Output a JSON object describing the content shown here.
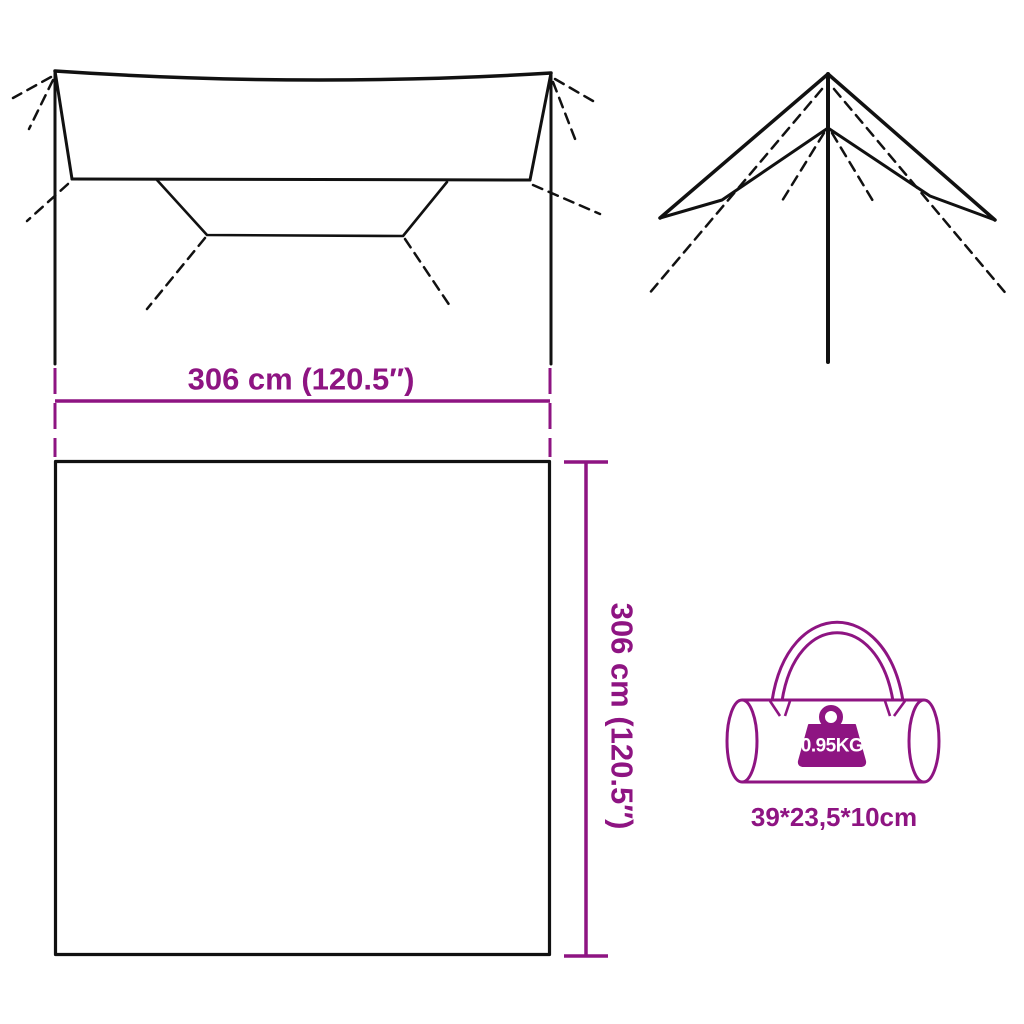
{
  "page": {
    "type": "product-dimension-diagram",
    "background": "#ffffff"
  },
  "colors": {
    "accent": "#8E1482",
    "ink": "#111111",
    "weight_text": "#ffffff"
  },
  "dimensions": {
    "width_label": "306 cm (120.5″)",
    "height_label": "306 cm (120.5″)"
  },
  "bag": {
    "weight_label": "0.95KG",
    "size_label": "39*23,5*10cm"
  },
  "icons": {
    "tarp_top_view": "tarp-top-view-drawing",
    "tarp_pitched_view": "tarp-pitched-view-drawing",
    "tarp_flat_square": "tarp-flat-outline",
    "carry_bag": "carry-bag-icon",
    "weight": "weight-icon"
  }
}
